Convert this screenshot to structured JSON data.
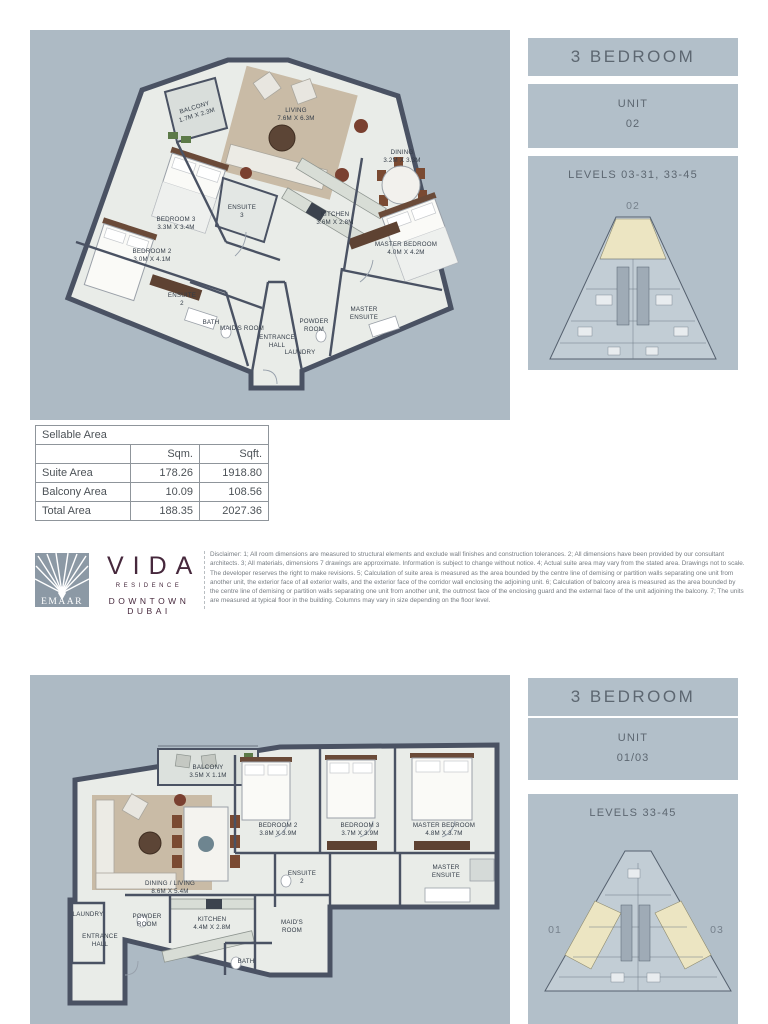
{
  "colors": {
    "panel_bg": "#adbac4",
    "box_bg": "#b2bfc9",
    "wall": "#4a5263",
    "room_fill": "#e9ece8",
    "keyplan_fill": "#c2cdd5",
    "keyplan_highlight": "#ece5c2",
    "vida_maroon": "#46283c",
    "emaar_gray": "#8c99a5"
  },
  "top_unit": {
    "type_header": "3 BEDROOM",
    "unit_label": "UNIT",
    "unit_number": "02",
    "levels_label": "LEVELS 03-31, 33-45",
    "keyplan": {
      "unit": "02"
    },
    "plan": {
      "balcony": {
        "l1": "BALCONY",
        "l2": "1.7M X 2.3M"
      },
      "living": {
        "l1": "LIVING",
        "l2": "7.6M X 6.3M"
      },
      "dining": {
        "l1": "DINING",
        "l2": "3.2M X 3.3M"
      },
      "kitchen": {
        "l1": "KITCHEN",
        "l2": "3.6M X 2.8M"
      },
      "master_bedroom": {
        "l1": "MASTER BEDROOM",
        "l2": "4.0M X 4.2M"
      },
      "bedroom3": {
        "l1": "BEDROOM 3",
        "l2": "3.3M X 3.4M"
      },
      "bedroom2": {
        "l1": "BEDROOM 2",
        "l2": "3.0M X 4.1M"
      },
      "ensuite3": {
        "l1": "ENSUITE",
        "l2": "3"
      },
      "ensuite2": {
        "l1": "ENSUITE",
        "l2": "2"
      },
      "bath": {
        "l1": "BATH",
        "l2": ""
      },
      "maids_room": {
        "l1": "MAID'S ROOM",
        "l2": ""
      },
      "entrance_hall": {
        "l1": "ENTRANCE",
        "l2": "HALL"
      },
      "powder_room": {
        "l1": "POWDER",
        "l2": "ROOM"
      },
      "laundry": {
        "l1": "LAUNDRY",
        "l2": ""
      },
      "master_ensuite": {
        "l1": "MASTER",
        "l2": "ENSUITE"
      }
    }
  },
  "area_table": {
    "title": "Sellable Area",
    "col_sqm": "Sqm.",
    "col_sqft": "Sqft.",
    "rows": [
      {
        "label": "Suite Area",
        "sqm": "178.26",
        "sqft": "1918.80"
      },
      {
        "label": "Balcony Area",
        "sqm": "10.09",
        "sqft": "108.56"
      },
      {
        "label": "Total Area",
        "sqm": "188.35",
        "sqft": "2027.36"
      }
    ]
  },
  "branding": {
    "emaar": "EMAAR",
    "vida": "VIDA",
    "residence": "RESIDENCE",
    "downtown": "DOWNTOWN DUBAI",
    "disclaimer": "Disclaimer: 1; All room dimensions are measured to structural elements and exclude wall finishes and construction tolerances. 2; All dimensions have been provided by our consultant architects. 3; All materials, dimensions 7 drawings are approximate. Information is subject to change without notice. 4; Actual suite area may vary from the stated area. Drawings not to scale. The developer reserves the right to make revisions. 5; Calculation of suite area is measured as the area bounded by the centre line of demising or partition walls separating one unit from another unit, the exterior face of all exterior walls, and the exterior face of the corridor wall enclosing the adjoining unit. 6; Calculation of balcony area is measured as the area bounded by the centre line of demising or partition walls separating one unit from another unit, the outmost face of the enclosing guard and the external face of the unit adjoining the balcony. 7; The units are measured at typical floor in the building. Columns may vary in size depending on the floor level."
  },
  "bottom_unit": {
    "type_header": "3 BEDROOM",
    "unit_label": "UNIT",
    "unit_number": "01/03",
    "levels_label": "LEVELS 33-45",
    "keyplan": {
      "left": "01",
      "right": "03"
    },
    "plan": {
      "balcony": {
        "l1": "BALCONY",
        "l2": "3.5M X 1.1M"
      },
      "dining_living": {
        "l1": "DINING / LIVING",
        "l2": "8.6M X 5.4M"
      },
      "bedroom2": {
        "l1": "BEDROOM 2",
        "l2": "3.8M X 3.9M"
      },
      "bedroom3": {
        "l1": "BEDROOM 3",
        "l2": "3.7M X 3.9M"
      },
      "master_bedroom": {
        "l1": "MASTER BEDROOM",
        "l2": "4.8M X 3.7M"
      },
      "ensuite2": {
        "l1": "ENSUITE",
        "l2": "2"
      },
      "master_ensuite": {
        "l1": "MASTER",
        "l2": "ENSUITE"
      },
      "laundry": {
        "l1": "LAUNDRY",
        "l2": ""
      },
      "powder_room": {
        "l1": "POWDER",
        "l2": "ROOM"
      },
      "entrance_hall": {
        "l1": "ENTRANCE",
        "l2": "HALL"
      },
      "kitchen": {
        "l1": "KITCHEN",
        "l2": "4.4M X 2.8M"
      },
      "maids_room": {
        "l1": "MAID'S",
        "l2": "ROOM"
      },
      "bath": {
        "l1": "BATH",
        "l2": ""
      }
    }
  }
}
